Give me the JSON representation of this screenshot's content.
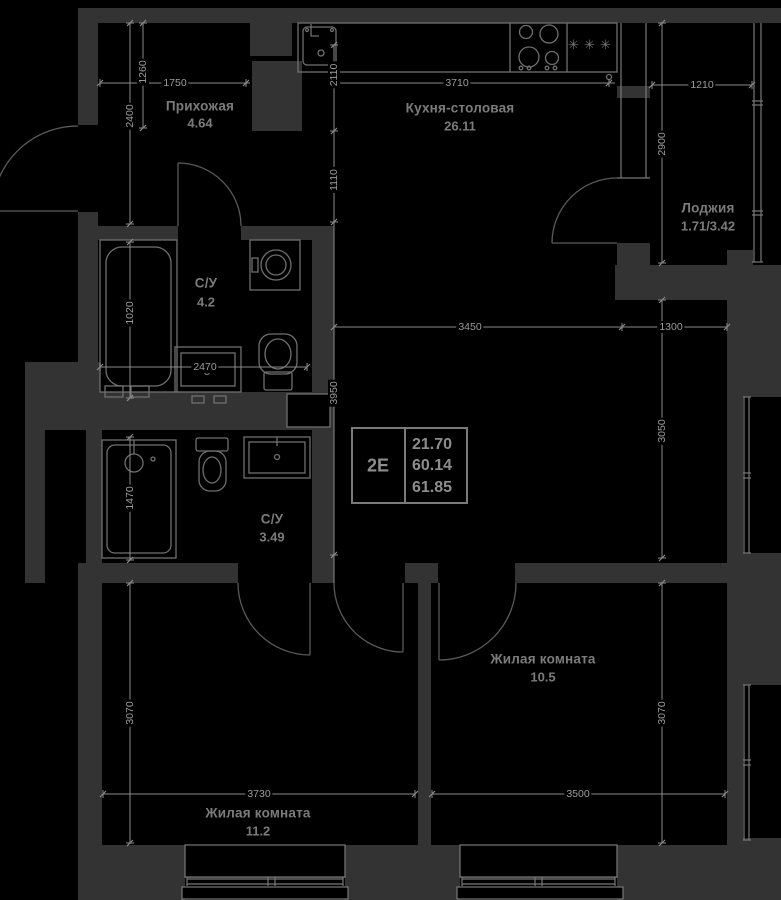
{
  "plan": {
    "type_label": "2Е",
    "area_living": "21.70",
    "area_main": "60.14",
    "area_total": "61.85"
  },
  "rooms": [
    {
      "name": "Прихожая",
      "area": "4.64"
    },
    {
      "name": "Кухня-столовая",
      "area": "26.11"
    },
    {
      "name": "Лоджия",
      "area": "1.71/3.42"
    },
    {
      "name": "С/У",
      "area": "4.2"
    },
    {
      "name": "С/У",
      "area": "3.49"
    },
    {
      "name": "Жилая комната",
      "area": "10.5"
    },
    {
      "name": "Жилая комната",
      "area": "11.2"
    }
  ],
  "dimensions_mm": [
    {
      "value": "1750"
    },
    {
      "value": "3710"
    },
    {
      "value": "1210"
    },
    {
      "value": "1260"
    },
    {
      "value": "2400"
    },
    {
      "value": "2110"
    },
    {
      "value": "1110"
    },
    {
      "value": "2900"
    },
    {
      "value": "1020"
    },
    {
      "value": "2470"
    },
    {
      "value": "3450"
    },
    {
      "value": "1300"
    },
    {
      "value": "3950"
    },
    {
      "value": "3050"
    },
    {
      "value": "1470"
    },
    {
      "value": "3070"
    },
    {
      "value": "3070"
    },
    {
      "value": "3730"
    },
    {
      "value": "3500"
    }
  ],
  "icons": {
    "fridge_symbol": "✳✳✳"
  },
  "colors": {
    "background": "#000000",
    "wall": "#333333",
    "fixture_line": "#6f6f6f",
    "dim_line": "#8a8a8a",
    "room_text": "#7b7b7b",
    "dim_text": "#9c9c9c"
  }
}
